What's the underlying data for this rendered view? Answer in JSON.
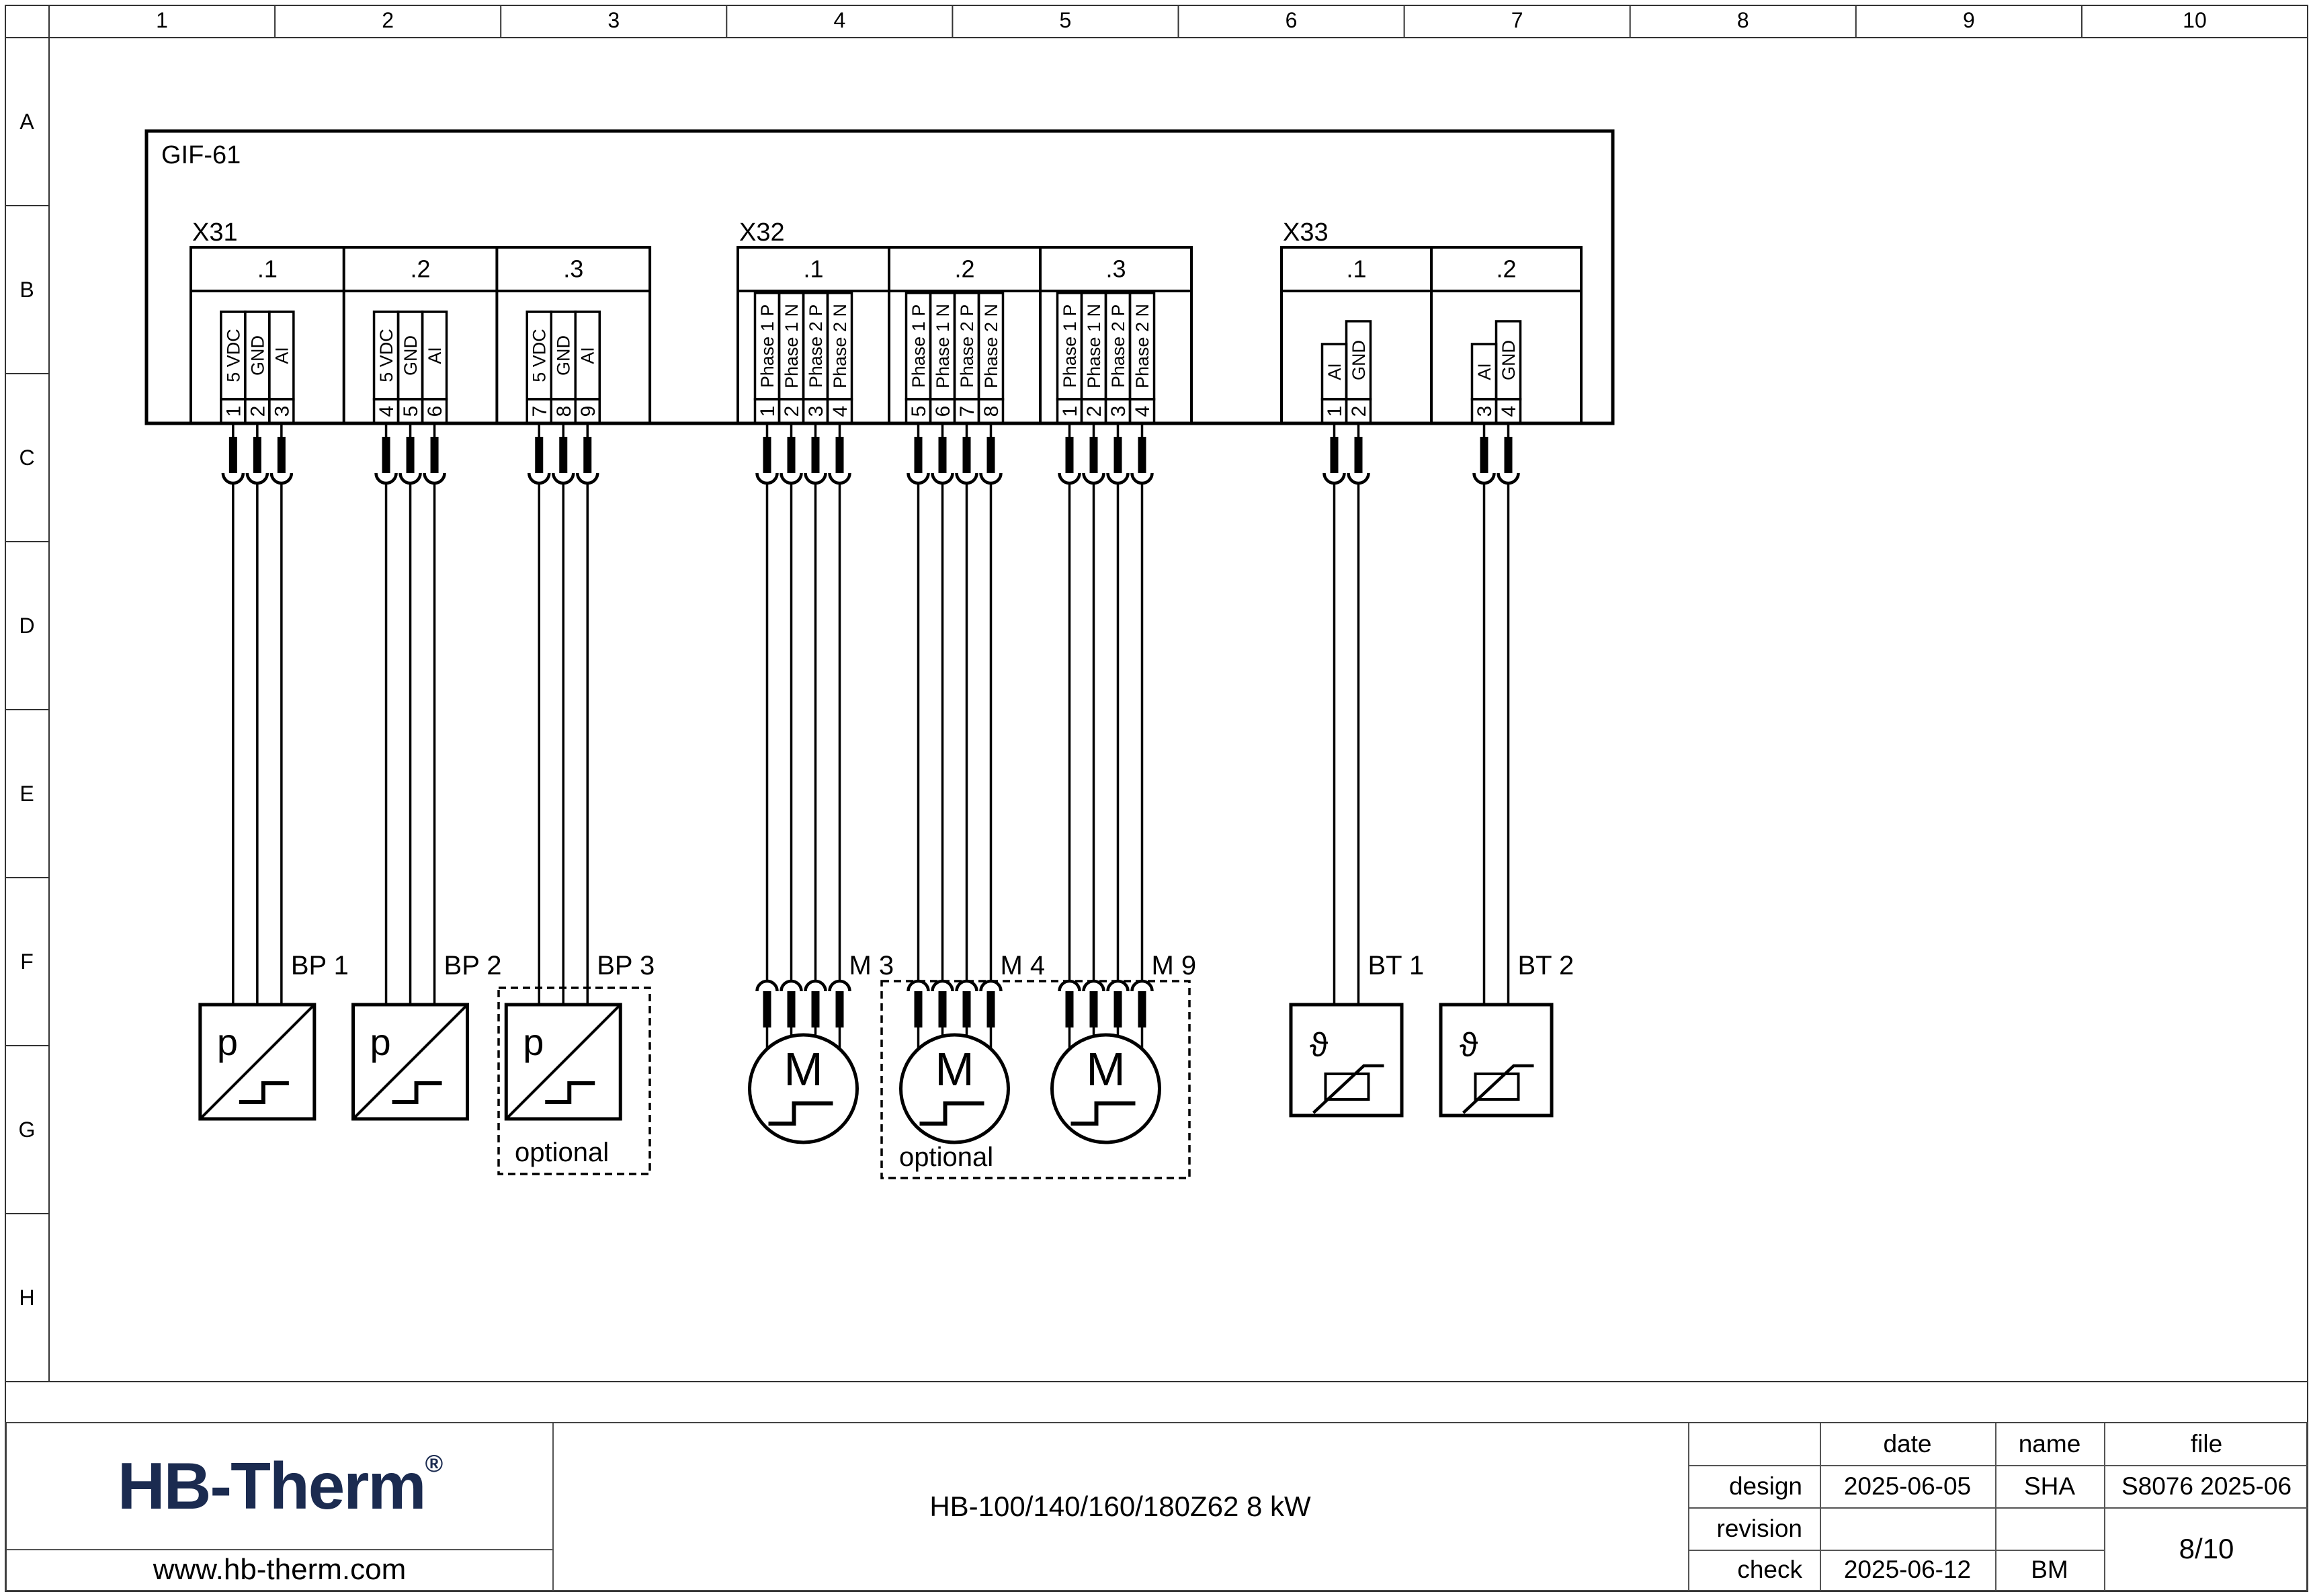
{
  "sheet": {
    "columns": [
      "1",
      "2",
      "3",
      "4",
      "5",
      "6",
      "7",
      "8",
      "9",
      "10"
    ],
    "rows": [
      "A",
      "B",
      "C",
      "D",
      "E",
      "F",
      "G",
      "H"
    ]
  },
  "diagram": {
    "device_label": "GIF-61",
    "optional_label": "optional",
    "connectors": [
      {
        "name": "X31",
        "cells": [
          {
            "label": ".1",
            "pins": [
              {
                "number": "1",
                "signal": "5 VDC"
              },
              {
                "number": "2",
                "signal": "GND"
              },
              {
                "number": "3",
                "signal": "AI"
              }
            ]
          },
          {
            "label": ".2",
            "pins": [
              {
                "number": "4",
                "signal": "5 VDC"
              },
              {
                "number": "5",
                "signal": "GND"
              },
              {
                "number": "6",
                "signal": "AI"
              }
            ]
          },
          {
            "label": ".3",
            "pins": [
              {
                "number": "7",
                "signal": "5 VDC"
              },
              {
                "number": "8",
                "signal": "GND"
              },
              {
                "number": "9",
                "signal": "AI"
              }
            ]
          }
        ]
      },
      {
        "name": "X32",
        "cells": [
          {
            "label": ".1",
            "pins": [
              {
                "number": "1",
                "signal": "Phase 1 P"
              },
              {
                "number": "2",
                "signal": "Phase 1 N"
              },
              {
                "number": "3",
                "signal": "Phase 2 P"
              },
              {
                "number": "4",
                "signal": "Phase 2 N"
              }
            ]
          },
          {
            "label": ".2",
            "pins": [
              {
                "number": "5",
                "signal": "Phase 1 P"
              },
              {
                "number": "6",
                "signal": "Phase 1 N"
              },
              {
                "number": "7",
                "signal": "Phase 2 P"
              },
              {
                "number": "8",
                "signal": "Phase 2 N"
              }
            ]
          },
          {
            "label": ".3",
            "pins": [
              {
                "number": "1",
                "signal": "Phase 1 P"
              },
              {
                "number": "2",
                "signal": "Phase 1 N"
              },
              {
                "number": "3",
                "signal": "Phase 2 P"
              },
              {
                "number": "4",
                "signal": "Phase 2 N"
              }
            ]
          }
        ]
      },
      {
        "name": "X33",
        "cells": [
          {
            "label": ".1",
            "pins": [
              {
                "number": "1",
                "signal": "AI"
              },
              {
                "number": "2",
                "signal": "GND"
              }
            ]
          },
          {
            "label": ".2",
            "pins": [
              {
                "number": "3",
                "signal": "AI"
              },
              {
                "number": "4",
                "signal": "GND"
              }
            ]
          }
        ]
      }
    ],
    "components": [
      {
        "label": "BP 1",
        "type": "pressure-sensor",
        "symbol": "p",
        "optional": false
      },
      {
        "label": "BP 2",
        "type": "pressure-sensor",
        "symbol": "p",
        "optional": false
      },
      {
        "label": "BP 3",
        "type": "pressure-sensor",
        "symbol": "p",
        "optional": true
      },
      {
        "label": "M 3",
        "type": "motor",
        "symbol": "M",
        "optional": false
      },
      {
        "label": "M 4",
        "type": "motor",
        "symbol": "M",
        "optional": true
      },
      {
        "label": "M 9",
        "type": "motor",
        "symbol": "M",
        "optional": true
      },
      {
        "label": "BT 1",
        "type": "temperature-sensor",
        "symbol": "ϑ",
        "optional": false
      },
      {
        "label": "BT 2",
        "type": "temperature-sensor",
        "symbol": "ϑ",
        "optional": false
      }
    ]
  },
  "title_block": {
    "logo_text": "HB-Therm",
    "logo_mark": "®",
    "website": "www.hb-therm.com",
    "drawing_title": "HB-100/140/160/180Z62 8 kW",
    "table": {
      "headers": [
        "date",
        "name",
        "file"
      ],
      "rows": [
        {
          "label": "design",
          "date": "2025-06-05",
          "name": "SHA",
          "file": "S8076 2025-06"
        },
        {
          "label": "revision",
          "date": "",
          "name": "",
          "file": ""
        },
        {
          "label": "check",
          "date": "2025-06-12",
          "name": "BM",
          "file": ""
        }
      ],
      "page": "8/10"
    }
  },
  "colors": {
    "line": "#000000",
    "title_block_line": "#555555",
    "logo_navy": "#1b2b50"
  }
}
